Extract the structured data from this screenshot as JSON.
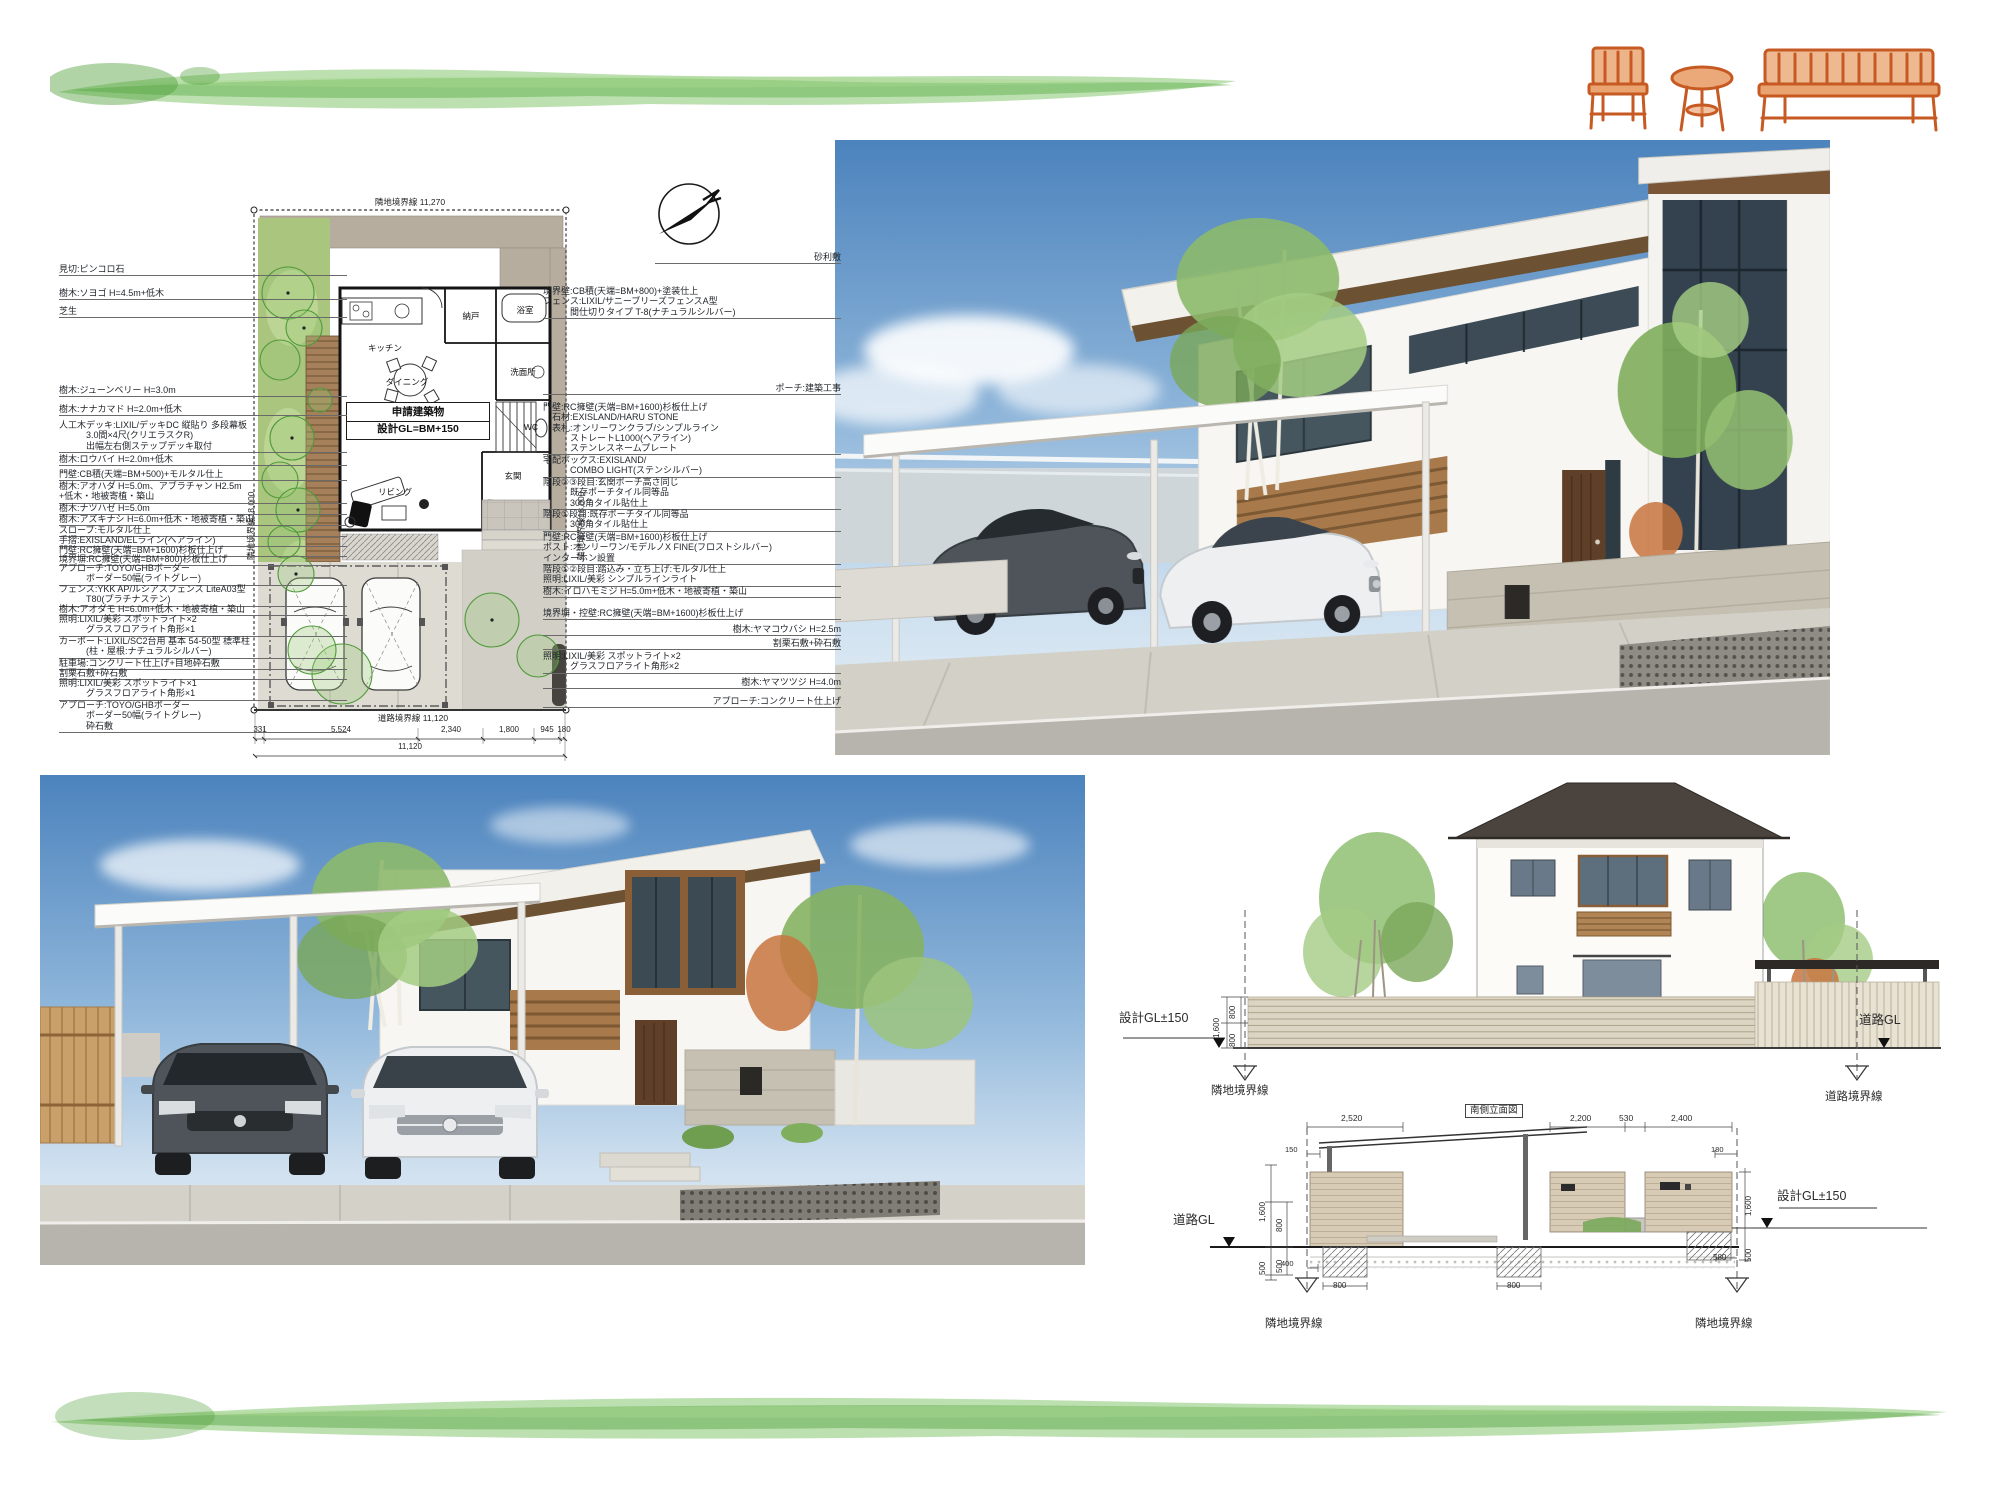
{
  "colors": {
    "brush_green": "#79c261",
    "brush_green_dark": "#4fa03a",
    "brush_green_light": "#a9da92",
    "furniture_orange": "#c75a22",
    "sky_top": "#4c83bd",
    "roof_dark": "#4b443e",
    "wood_accent": "#8a5f38",
    "tree_green": "#8cb96b",
    "stone_wall": "#c6c0b2",
    "car_gray": "#4e545a",
    "car_white": "#edeff0",
    "plan_grass": "#a9c57e",
    "plan_deck": "#a5805a",
    "plan_gravel": "#b6ad9f"
  },
  "site_plan": {
    "title_box": {
      "line1": "申請建築物",
      "line2": "設計GL=BM+150"
    },
    "rooms": [
      {
        "t": "キッチン",
        "x": 330,
        "y": 208
      },
      {
        "t": "納戸",
        "x": 416,
        "y": 176
      },
      {
        "t": "浴室",
        "x": 470,
        "y": 170
      },
      {
        "t": "洗面所",
        "x": 468,
        "y": 232
      },
      {
        "t": "ダイニング",
        "x": 352,
        "y": 242
      },
      {
        "t": "WC",
        "x": 476,
        "y": 287
      },
      {
        "t": "玄関",
        "x": 458,
        "y": 336
      },
      {
        "t": "リビング",
        "x": 340,
        "y": 352
      }
    ],
    "annotations": [
      {
        "t": "隣地境界線 11,270",
        "x": 355,
        "y": 56,
        "s": 8.5,
        "c": 1
      },
      {
        "t": "隣地境界線18,000",
        "x": 190,
        "y": 420,
        "r": -90,
        "s": 8.5
      },
      {
        "t": "隣地境界線18,000",
        "x": 520,
        "y": 420,
        "r": -90,
        "s": 8.5
      },
      {
        "t": "道路境界線 11,120",
        "x": 358,
        "y": 572,
        "s": 8.5,
        "c": 1
      },
      {
        "t": "331",
        "x": 205,
        "y": 585,
        "s": 8,
        "c": 1
      },
      {
        "t": "5,524",
        "x": 286,
        "y": 585,
        "s": 8,
        "c": 1
      },
      {
        "t": "2,340",
        "x": 396,
        "y": 585,
        "s": 8,
        "c": 1
      },
      {
        "t": "1,800",
        "x": 454,
        "y": 585,
        "s": 8,
        "c": 1
      },
      {
        "t": "945",
        "x": 492,
        "y": 585,
        "s": 8,
        "c": 1
      },
      {
        "t": "180",
        "x": 509,
        "y": 585,
        "s": 8,
        "c": 1
      },
      {
        "t": "11,120",
        "x": 355,
        "y": 602,
        "s": 8,
        "c": 1
      }
    ],
    "left_labels": [
      {
        "t": "見切:ピンコロ石",
        "y": 124
      },
      {
        "t": "樹木:ソヨゴ H=4.5m+低木",
        "y": 148
      },
      {
        "t": "芝生",
        "y": 166
      },
      {
        "t": "樹木:ジューンベリー H=3.0m",
        "y": 245
      },
      {
        "t": "樹木:ナナカマド H=2.0m+低木",
        "y": 264
      },
      {
        "t": "人工木デッキ:LIXIL/デッキDC 縦貼り 多段幕板\n　　　3.0間×4尺(クリエラスクR)\n　　　出幅左右側ステップデッキ取付",
        "y": 280
      },
      {
        "t": "樹木:ロウバイ H=2.0m+低木",
        "y": 314
      },
      {
        "t": "門壁:CB積(天端=BM+500)+モルタル仕上",
        "y": 329
      },
      {
        "t": "樹木:アオハダ H=5.0m、アブラチャン H2.5m\n+低木・地被寄植・築山",
        "y": 341
      },
      {
        "t": "樹木:ナツハゼ H=5.0m",
        "y": 363
      },
      {
        "t": "樹木:アズキナシ H=6.0m+低木・地被寄植・築山",
        "y": 374
      },
      {
        "t": "スロープ:モルタル仕上",
        "y": 385
      },
      {
        "t": "手摺:EXISLAND/ELライン(ヘアライン)",
        "y": 395
      },
      {
        "t": "門壁:RC擁壁(天端=BM+1600)杉板仕上げ",
        "y": 405
      },
      {
        "t": "境界塀:RC擁壁(天端=BM+800)杉板仕上げ",
        "y": 414
      },
      {
        "t": "アプローチ:TOYO/GHBボーダー\n　　　ボーダー50幅(ライトグレー)",
        "y": 423
      },
      {
        "t": "フェンス:YKK AP/ルシアスフェンス LiteA03型\n　　　T80(プラチナステン)",
        "y": 444
      },
      {
        "t": "樹木:アオダモ H=6.0m+低木・地被寄植・築山",
        "y": 464
      },
      {
        "t": "照明:LIXIL/美彩 スポットライト×2\n　　　グラスフロアライト角形×1",
        "y": 474
      },
      {
        "t": "カーポート:LIXIL/SC2台用 基本 54-50型 標準柱\n　　　(柱・屋根:ナチュラルシルバー)",
        "y": 496
      },
      {
        "t": "駐車場:コンクリート仕上げ+目地砕石敷",
        "y": 518
      },
      {
        "t": "割栗石敷+砕石敷",
        "y": 528
      },
      {
        "t": "照明:LIXIL/美彩 スポットライト×1\n　　　グラスフロアライト角形×1",
        "y": 538
      },
      {
        "t": "アプローチ:TOYO/GHBボーダー\n　　　ボーダー50幅(ライトグレー)\n　　　砕石敷",
        "y": 560
      }
    ],
    "right_labels": [
      {
        "t": "砂利敷",
        "y": 112,
        "x": 600,
        "w": 186,
        "a": "right"
      },
      {
        "t": "境界壁:CB積(天端=BM+800)+塗装仕上\nフェンス:LIXIL/サニーブリーズフェンスA型\n　　　間仕切りタイプ T-8(ナチュラルシルバー)",
        "y": 146
      },
      {
        "t": "ポーチ:建築工事",
        "y": 243,
        "a": "right"
      },
      {
        "t": "門壁:RC擁壁(天端=BM+1600)杉板仕上げ\n　石材:EXISLAND/HARU STONE\n　表札:オンリーワンクラブ/シンプルライン\n　　　ストレートL1000(ヘアライン)\n　　　ステンレスネームプレート",
        "y": 262
      },
      {
        "t": "宅配ボックス:EXISLAND/\n　　　COMBO LIGHT(ステンシルバー)",
        "y": 315
      },
      {
        "t": "階段②③段目:玄関ポーチ高さ同じ\n　　　既存ポーチタイル同等品\n　　　300角タイル貼仕上",
        "y": 337
      },
      {
        "t": "階段①段目:既存ポーチタイル同等品\n　　　300角タイル貼仕上",
        "y": 369
      },
      {
        "t": "門壁:RC擁壁(天端=BM+1600)杉板仕上げ\nポスト:オンリーワン/モデルノX FINE(フロストシルバー)\nインターホン設置",
        "y": 392
      },
      {
        "t": "階段①②段目:踏込み・立ち上げ:モルタル仕上\n照明:LIXIL/美彩 シンプルラインライト",
        "y": 424
      },
      {
        "t": "樹木:イロハモミジ H=5.0m+低木・地被寄植・築山",
        "y": 446
      },
      {
        "t": "境界塀・控壁:RC擁壁(天端=BM+1600)杉板仕上げ",
        "y": 468
      },
      {
        "t": "樹木:ヤマコウバシ H=2.5m",
        "y": 484,
        "a": "right"
      },
      {
        "t": "割栗石敷+砕石敷",
        "y": 498,
        "a": "right"
      },
      {
        "t": "照明:LIXIL/美彩 スポットライト×2\n　　　グラスフロアライト角形×2",
        "y": 511
      },
      {
        "t": "樹木:ヤマツツジ H=4.0m",
        "y": 537,
        "a": "right"
      },
      {
        "t": "アプローチ:コンクリート仕上げ",
        "y": 556,
        "a": "right"
      }
    ]
  },
  "elevation": {
    "texts": [
      {
        "t": "設計GL±150",
        "x": 4,
        "y": 242,
        "s": 12.5
      },
      {
        "t": "1,600",
        "x": 98,
        "y": 268,
        "r": -90,
        "s": 8
      },
      {
        "t": "800",
        "x": 114,
        "y": 249,
        "r": -90,
        "s": 8
      },
      {
        "t": "800",
        "x": 114,
        "y": 277,
        "r": -90,
        "s": 8
      },
      {
        "t": "隣地境界線",
        "x": 96,
        "y": 316,
        "s": 11.5
      },
      {
        "t": "道路GL",
        "x": 744,
        "y": 244,
        "s": 12.5
      },
      {
        "t": "道路境界線",
        "x": 710,
        "y": 322,
        "s": 11.5
      },
      {
        "t": "隣地境界線",
        "x": 150,
        "y": 549,
        "s": 11.5
      },
      {
        "t": "隣地境界線",
        "x": 580,
        "y": 549,
        "s": 11.5
      },
      {
        "t": "道路GL",
        "x": 58,
        "y": 444,
        "s": 12.5
      },
      {
        "t": "設計GL±150",
        "x": 662,
        "y": 420,
        "s": 12.5
      },
      {
        "t": "南側立面図",
        "x": 350,
        "y": 334,
        "s": 9.5,
        "b": 1
      },
      {
        "t": "2,520",
        "x": 226,
        "y": 344,
        "s": 8.5
      },
      {
        "t": "150",
        "x": 170,
        "y": 376,
        "s": 7.5
      },
      {
        "t": "2,200",
        "x": 455,
        "y": 344,
        "s": 8.5
      },
      {
        "t": "530",
        "x": 504,
        "y": 344,
        "s": 8.5
      },
      {
        "t": "2,400",
        "x": 556,
        "y": 344,
        "s": 8.5
      },
      {
        "t": "180",
        "x": 596,
        "y": 376,
        "s": 7.5
      },
      {
        "t": "1,600",
        "x": 144,
        "y": 452,
        "r": -90,
        "s": 8
      },
      {
        "t": "800",
        "x": 161,
        "y": 462,
        "r": -90,
        "s": 8
      },
      {
        "t": "500",
        "x": 144,
        "y": 505,
        "r": -90,
        "s": 8
      },
      {
        "t": "500",
        "x": 161,
        "y": 503,
        "r": -90,
        "s": 8
      },
      {
        "t": "400",
        "x": 166,
        "y": 490,
        "s": 7.5
      },
      {
        "t": "1,600",
        "x": 630,
        "y": 446,
        "r": -90,
        "s": 8
      },
      {
        "t": "500",
        "x": 630,
        "y": 492,
        "r": -90,
        "s": 8
      },
      {
        "t": "800",
        "x": 218,
        "y": 512,
        "s": 8
      },
      {
        "t": "800",
        "x": 392,
        "y": 512,
        "s": 8
      },
      {
        "t": "580",
        "x": 598,
        "y": 484,
        "s": 8
      }
    ]
  }
}
